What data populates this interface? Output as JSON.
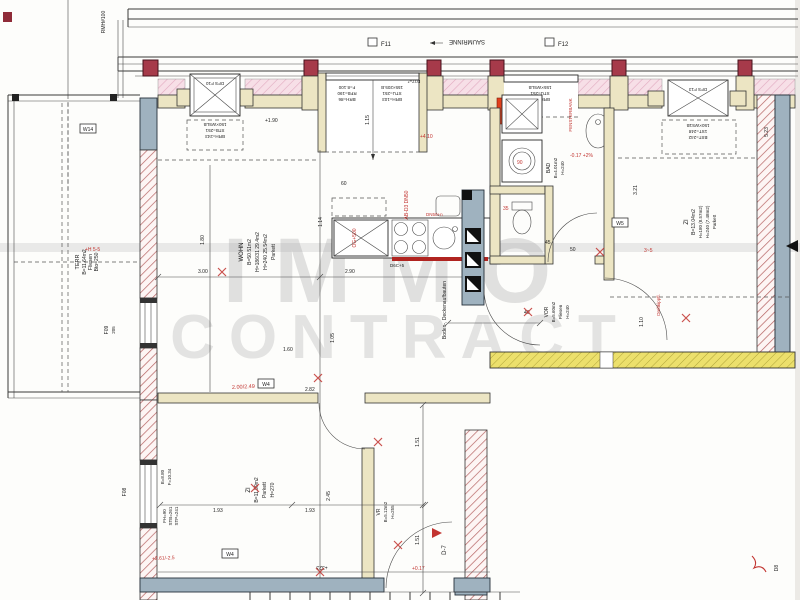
{
  "t": {
    "f11": "F11",
    "f12": "F12",
    "saumrinne": "SAUMRINNE",
    "rmh": "RMH#100",
    "s1l1": "DFS F10",
    "s1l2": "150×WSLB",
    "s1l3": "STB=251",
    "s1l4": "BRH=243",
    "s3l1": "DFS F13",
    "s3l2": "150×WS1B",
    "s3l3": "1ST=248",
    "s3l4": "BST=242",
    "dwl1": "F=8.100",
    "dwl2": "RFB=190",
    "dwl3": "BRH=86",
    "dwr1": "155×205.B",
    "dwr2": "STU=251",
    "dwr3": "BRH=103",
    "d17": "D17=*",
    "bwl1": "155×WSLB",
    "bwl2": "STU=251",
    "bwl3": "BRH=103",
    "terr1": "TERR",
    "terr2": "B=11.64m2",
    "terr3": "Fliesen",
    "terr4": "Bto=250",
    "wohn1": "WOHN",
    "wohn2": "B=50.51m2",
    "wohn3": "H=186/31 29.4m2",
    "wohn4": "H=240 25.54m2",
    "wohn5": "Parkett",
    "zir1": "ZI",
    "zir2": "B=13.04m2",
    "zir3": "H=180 (8.57m2)",
    "zir4": "H=240 (7.48m2)",
    "zir5": "Parkett",
    "zib1": "ZI",
    "zib2": "B=11.99m2",
    "zib3": "Parkett",
    "zib4": "H=270",
    "vor1": "VOR",
    "vor2": "B=5.60m2",
    "vor3": "Fliesen",
    "vor4": "H=240",
    "vr1": "VR",
    "vr2": "B=5.12m2",
    "vr3": "H=255",
    "bad1": "BAD",
    "bad2": "B=4.01m2",
    "bad3": "H=240",
    "boden": "Boden-, Deckenaufbauten",
    "fenst": "FENSTERBANK",
    "f09a": "F09",
    "f09b": "205",
    "f08": "F08",
    "d7": "D-7",
    "d8": "D8",
    "w14": "W14",
    "w4a": "W4",
    "w4b": "W4",
    "w5": "W5",
    "dim180": "1.80",
    "dim114": "1.14",
    "dim115": "1.15",
    "dim190": "+1.90",
    "dim300": "3.00",
    "dim290": "2.90",
    "dim60": "60",
    "dim105": "1.05",
    "dim160": "1.60",
    "dim282": "2.82",
    "dim321": "3.21",
    "dim110": "1.10",
    "dim523": "5.23",
    "dim45": "45",
    "dim50": "50",
    "dim40": "40",
    "dim151a": "1.51",
    "dim151b": "1.51",
    "dim193a": "1.93",
    "dim193b": "1.93",
    "dim245": "2.45",
    "dim323": "+323",
    "lb1": "B=8.80",
    "lb2": "F=10.34",
    "lc1": "FH=90",
    "lc2": "STB=261",
    "lc3": "STP=241",
    "dec": "D6C+5",
    "r410": "+4.10",
    "r017": "-0.17 +2%",
    "r249": "2.00/2.49",
    "r261": "+2.61/-2.5",
    "r017b": "+0.17",
    "r35": "35",
    "r90": "90",
    "rab": "AB-D3 DN50",
    "rog": "OG+500",
    "rdn": "DN50+n",
    "r35b": "3~5",
    "rlevel": "+H 5-5",
    "dreh": "Drehkippfl.",
    "wm1": "IMMO",
    "wm2": "CONTRACT"
  }
}
